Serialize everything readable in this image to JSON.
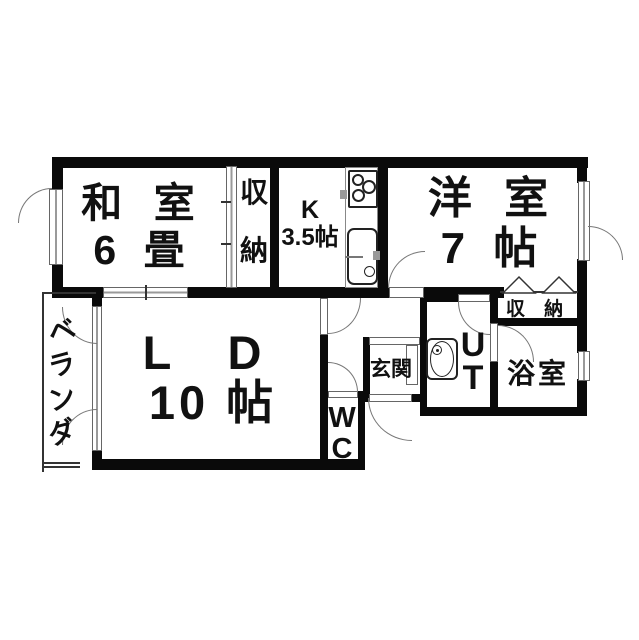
{
  "floorplan": {
    "type": "japanese-apartment-madori",
    "colors": {
      "wall": "#0a0a0a",
      "line": "#777777",
      "background": "#ffffff",
      "text": "#111111"
    },
    "rooms": {
      "washitsu": {
        "line1": "和 室",
        "line2": "6 畳"
      },
      "closet_washitsu": {
        "chars": [
          "収",
          "納"
        ]
      },
      "kitchen": {
        "line1": "K",
        "line2": "3.5帖"
      },
      "yoshitsu": {
        "line1": "洋 室",
        "line2": "7 帖"
      },
      "closet_yoshitsu": {
        "label": "収 納"
      },
      "living_dining": {
        "line1": "L D",
        "line2": "10 帖"
      },
      "bathroom": {
        "label": "浴室"
      },
      "utility": {
        "chars": [
          "U",
          "T"
        ]
      },
      "wc": {
        "chars": [
          "W",
          "C"
        ]
      },
      "genkan": {
        "label": "玄関"
      },
      "veranda": {
        "chars": [
          "ベ",
          "ラ",
          "ン",
          "ダ"
        ]
      }
    },
    "fixtures": [
      "stove",
      "kitchen-sink",
      "washbasin",
      "bifold-closet-door",
      "sliding-doors",
      "swing-doors"
    ]
  }
}
